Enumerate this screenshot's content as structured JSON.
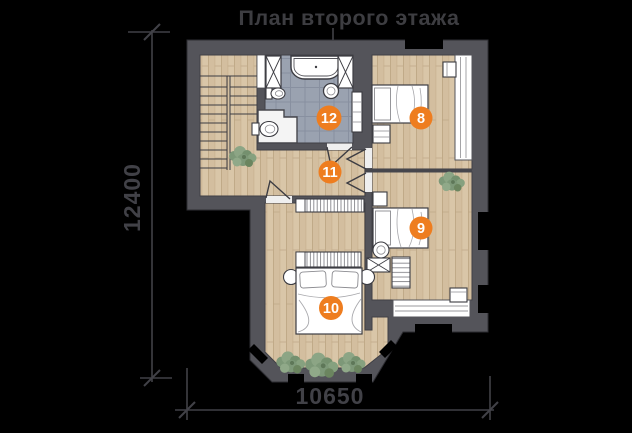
{
  "title": "План второго этажа",
  "dimensions": {
    "vertical": "12400",
    "horizontal": "10650"
  },
  "badges": [
    "8",
    "9",
    "10",
    "11",
    "12"
  ],
  "colors": {
    "background": "#000000",
    "wall_gray": "#54545a",
    "wood_floor": "#d9c6a8",
    "tile_floor": "#9aa2b0",
    "accent_orange": "#ee7d1f",
    "dimension_text": "#414147",
    "fixture_white": "#ffffff",
    "plant_green": "#7d9878"
  }
}
